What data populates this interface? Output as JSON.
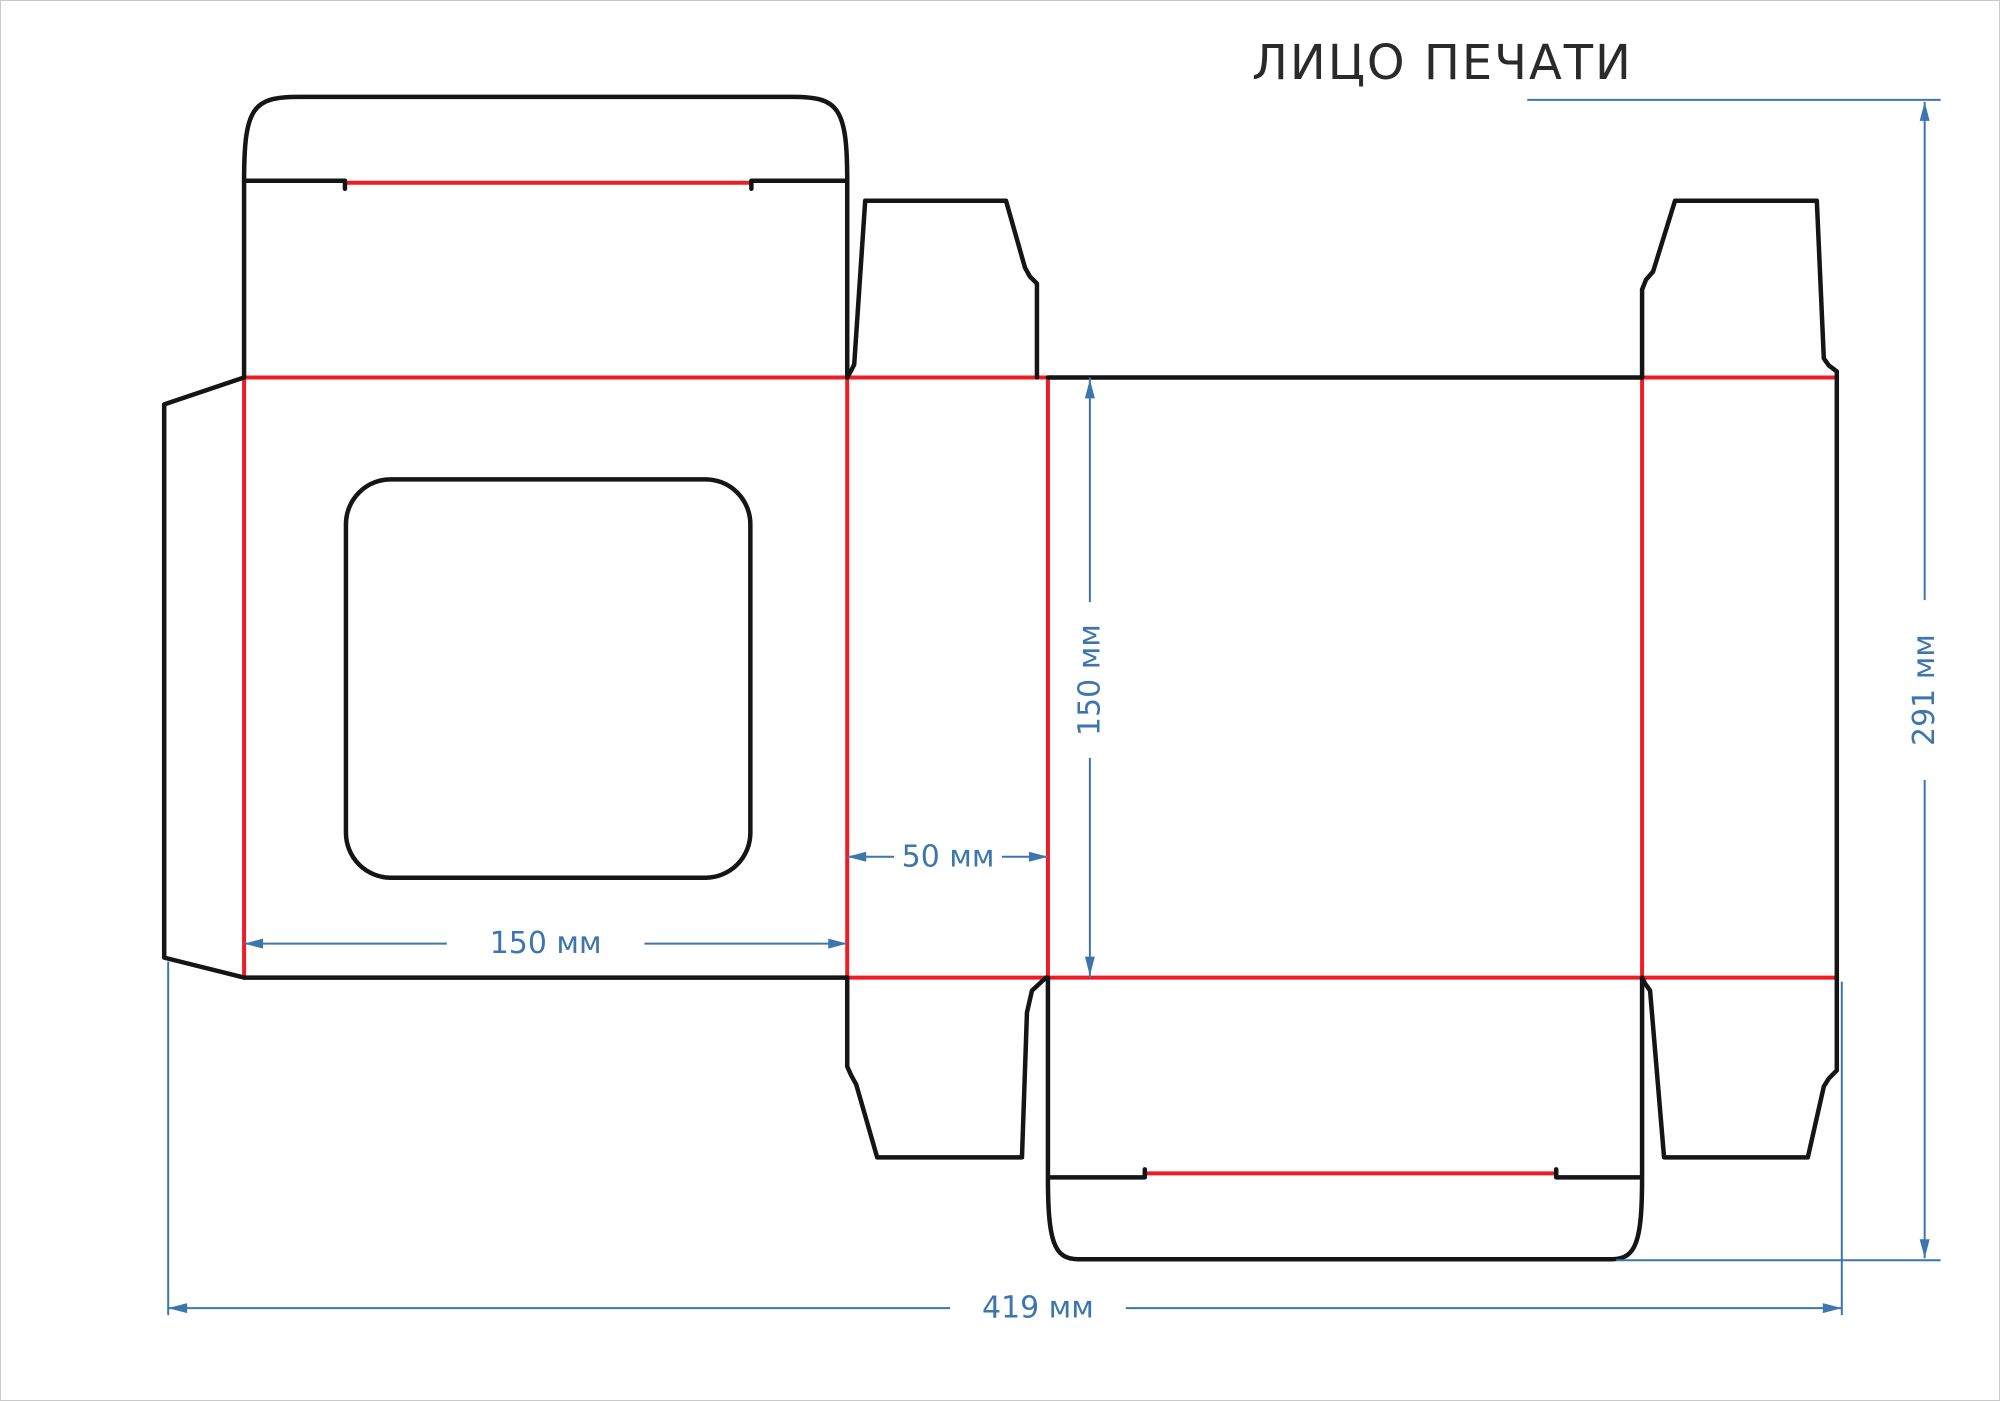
{
  "title": "ЛИЦО ПЕЧАТИ",
  "dimensions": {
    "front_panel_width": "150 мм",
    "side_panel_width": "50 мм",
    "panel_height": "150 мм",
    "total_width": "419 мм",
    "total_height": "291 мм"
  },
  "colors": {
    "cut_line": "#151515",
    "crease_line": "#ee1c25",
    "dimension_line": "#3c76ad"
  },
  "diagram": {
    "type": "packaging-dieline",
    "measurements": [
      {
        "label": "150 мм",
        "value": 150,
        "unit": "мм",
        "orientation": "horizontal",
        "measures": "front-panel-width"
      },
      {
        "label": "50 мм",
        "value": 50,
        "unit": "мм",
        "orientation": "horizontal",
        "measures": "side-panel-width"
      },
      {
        "label": "150 мм",
        "value": 150,
        "unit": "мм",
        "orientation": "vertical",
        "measures": "panel-height"
      },
      {
        "label": "419 мм",
        "value": 419,
        "unit": "мм",
        "orientation": "horizontal",
        "measures": "total-flat-width"
      },
      {
        "label": "291 мм",
        "value": 291,
        "unit": "мм",
        "orientation": "vertical",
        "measures": "total-flat-height"
      }
    ],
    "line_legend": [
      {
        "name": "cut-line",
        "color": "#151515"
      },
      {
        "name": "crease-line",
        "color": "#ee1c25"
      },
      {
        "name": "dimension-line",
        "color": "#3c76ad"
      }
    ]
  }
}
